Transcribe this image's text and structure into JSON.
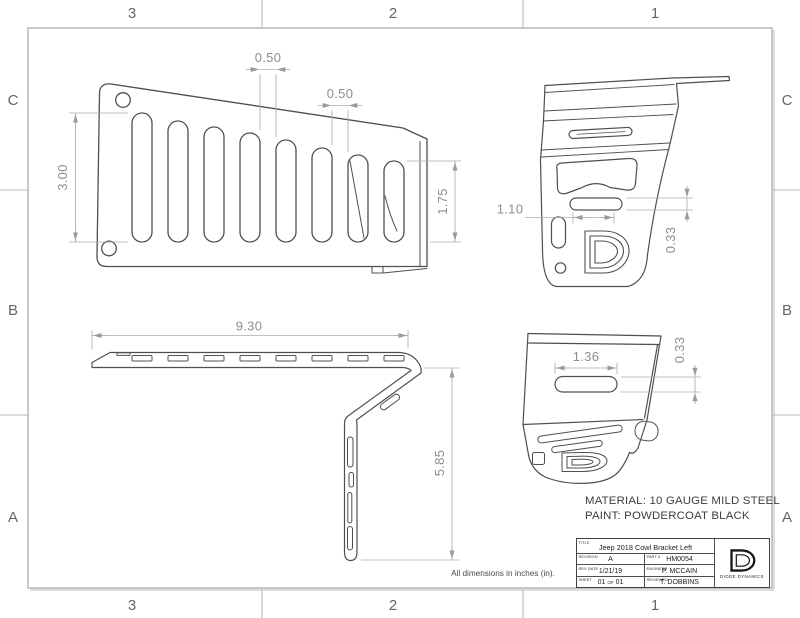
{
  "sheet": {
    "zones": {
      "columns": [
        "3",
        "2",
        "1"
      ],
      "rows": [
        "C",
        "B",
        "A"
      ]
    },
    "note": "All dimensions in inches (in).",
    "material_line1": "MATERIAL: 10 GAUGE MILD STEEL",
    "material_line2": "PAINT: POWDERCOAT BLACK"
  },
  "dimensions": {
    "front": {
      "slot_gap1": "0.50",
      "slot_gap2": "0.50",
      "slot_height_left": "3.00",
      "slot_height_right": "1.75"
    },
    "side": {
      "slot_width": "1.10",
      "slot_height": "0.33"
    },
    "top": {
      "overall_length": "9.30"
    },
    "leg": {
      "drop_height": "5.85"
    },
    "rear": {
      "slot_width": "1.36",
      "slot_height": "0.33"
    }
  },
  "title_block": {
    "labels": {
      "title": "TITLE",
      "revision": "REVISION",
      "part": "PART #",
      "rev_date": "REV DATE",
      "engineer": "ENGINEER",
      "sheet": "SHEET",
      "reviewed": "REVIEWED"
    },
    "title": "Jeep 2018 Cowl Bracket Left",
    "revision": "A",
    "part_number": "HM0054",
    "rev_date": "1/21/19",
    "engineer": "P. MCCAIN",
    "sheet_current": "01",
    "sheet_of": "OF",
    "sheet_total": "01",
    "reviewed": "T. DOBBINS",
    "company": "DIODE DYNAMICS"
  }
}
